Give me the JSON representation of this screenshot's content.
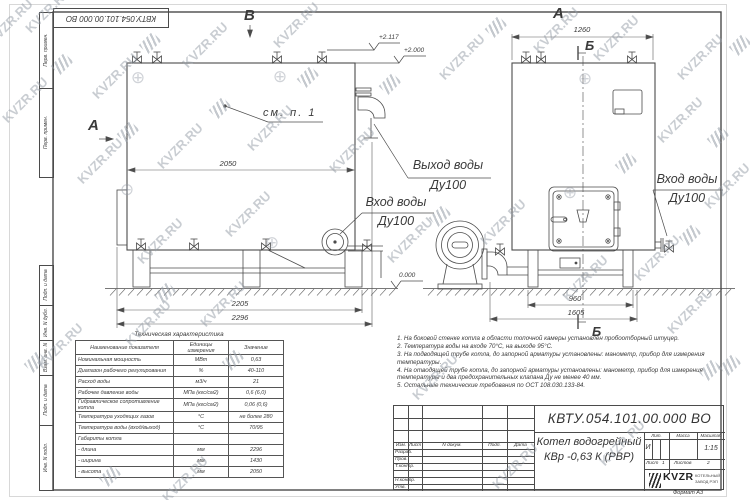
{
  "top_stamp": "КВТУ.054.101.00.000 ВО",
  "margin_column": {
    "cells": [
      "Перв. примен.",
      "Перв. примен.",
      "Подп. и дата",
      "Инв. N дубл.",
      "Взам. инв. N",
      "Подп. и дата",
      "Инв. N подл."
    ]
  },
  "drawing": {
    "view_labels": {
      "v_top": "В",
      "a_left": "А",
      "a_top": "А",
      "b_top": "Б",
      "b_bottom": "Б"
    },
    "callouts": {
      "see_note": "см. п. 1",
      "outlet": "Выход воды",
      "outlet_dn": "Ду100",
      "inlet_left": "Вход воды",
      "inlet_left_dn": "Ду100",
      "inlet_right": "Вход воды",
      "inlet_right_dn": "Ду100"
    },
    "elevations": {
      "top1": "+2.117",
      "top2": "+2.000",
      "zero": "0.000"
    },
    "dimensions": {
      "left_top": "2050",
      "left_bottom1": "2205",
      "left_bottom2": "2296",
      "right_top": "1260",
      "right_bottom1": "960",
      "right_bottom2": "1605"
    }
  },
  "tech_table": {
    "title": "Техническая характеристика",
    "headers": [
      "Наименование показателя",
      "Единицы измерения",
      "Значение"
    ],
    "rows": [
      [
        "Номинальная мощность",
        "МВт",
        "0,63"
      ],
      [
        "Диапазон рабочего регулирования",
        "%",
        "40-110"
      ],
      [
        "Расход воды",
        "м3/ч",
        "21"
      ],
      [
        "Рабочее давление воды",
        "МПа (кгс/см2)",
        "0,6 (6,0)"
      ],
      [
        "Гидравлическое сопротивление котла",
        "МПа (кгс/см2)",
        "0,06 (0,6)"
      ],
      [
        "Температура уходящих газов",
        "°С",
        "не более 280"
      ],
      [
        "Температура воды (вход/выход)",
        "°С",
        "70/95"
      ],
      [
        "Габариты котла",
        "",
        ""
      ],
      [
        "  - длина",
        "мм",
        "2296"
      ],
      [
        "  - ширина",
        "мм",
        "1430"
      ],
      [
        "  - высота",
        "мм",
        "2050"
      ]
    ]
  },
  "notes": [
    "1. На боковой стенке котла в области топочной камеры установлен пробоотборный штуцер.",
    "2. Температура воды на входе 70°С, на выходе 95°С.",
    "3. На подводящей трубе котла, до запорной арматуры установлены: манометр, прибор для измерения температуры.",
    "4. На отводящей трубе котла, до запорной арматуры установлены: манометр, прибор для измерения температуры и два предохранительных клапана Ду не менее 40 мм.",
    "5. Остальные технические требования по ОСТ 108.030.133-84."
  ],
  "title_block": {
    "doc_number": "КВТУ.054.101.00.000 ВО",
    "product_name_line1": "Котел водогрейный",
    "product_name_line2": "КВр -0,63 К (РВР)",
    "header_cells": [
      "Изм.",
      "Лист",
      "N докум.",
      "Подп.",
      "Дата"
    ],
    "row_labels": [
      "Разраб.",
      "Пров.",
      "Т.контр.",
      "Н.контр.",
      "Утв."
    ],
    "lit_label": "Лит.",
    "mass_label": "Масса",
    "scale_label": "Масштаб",
    "lit_value": "И",
    "scale_value": "1:15",
    "sheet_label": "Лист",
    "sheet_value": "1",
    "sheets_label": "Листов",
    "sheets_value": "2",
    "company": {
      "brand": "KVZR",
      "line1": "КОТЕЛЬНЫЙ",
      "line2": "ЗАВОД РЭП"
    },
    "format_label": "Формат  А3"
  },
  "watermark": {
    "text": "KVZR.RU",
    "color": "#949CA6"
  }
}
